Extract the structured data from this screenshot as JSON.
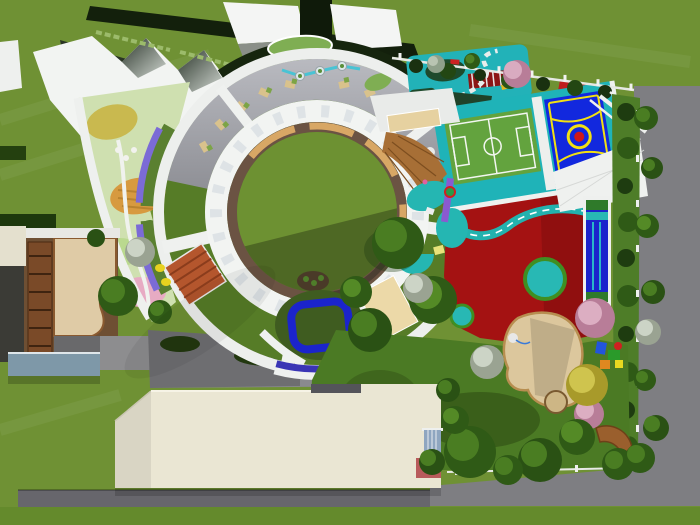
{
  "scene": {
    "type": "3d-aerial-render",
    "subject": "kindergarten-campus-site-plan",
    "view": "top-down"
  },
  "colors": {
    "grass": "#6f9134",
    "grass_shade": "#648a2c",
    "road": "#7e7e82",
    "road_dark": "#67666c",
    "white": "#eff1ef",
    "cream_building": "#eae6d3",
    "terrace_gray": "#a2a3a9",
    "ring_roof_green": "#567c27",
    "courtyard_lawn": "#6d9132",
    "path_ring_brown": "#6b5343",
    "bench_tan": "#d8a765",
    "tile_roof_red": "#b4562d",
    "deck_wood_brown": "#a76f36",
    "teal_surface": "#1fb3b8",
    "soccer_green": "#63a33e",
    "basketball_blue": "#1228de",
    "marking_yellow": "#f2e012",
    "playground_red": "#a41212",
    "pool_blue": "#1b24cc",
    "purple_strip": "#7b6bd6",
    "indigo_band": "#3a35b5",
    "sand": "#dcc79d",
    "canopy_blue_gray": "#7e98a8",
    "hedge_dark": "#16250e",
    "garden_yellow": "#c9b94f",
    "garden_orange": "#d79a40",
    "garden_pink": "#e7abc3",
    "garden_light_green": "#bad98f"
  },
  "areas": [
    "circular-main-building",
    "central-courtyard-lawn",
    "roof-terrace",
    "sawtooth-roof-block",
    "flower-garden",
    "sand-courtyard",
    "service-building",
    "cream-classroom-building",
    "wooden-fan-deck",
    "traffic-training-area",
    "soccer-field",
    "basketball-court",
    "tricycle-track-playground",
    "lap-pool",
    "sand-play-pit",
    "landscaped-play-garden",
    "perimeter-road"
  ]
}
